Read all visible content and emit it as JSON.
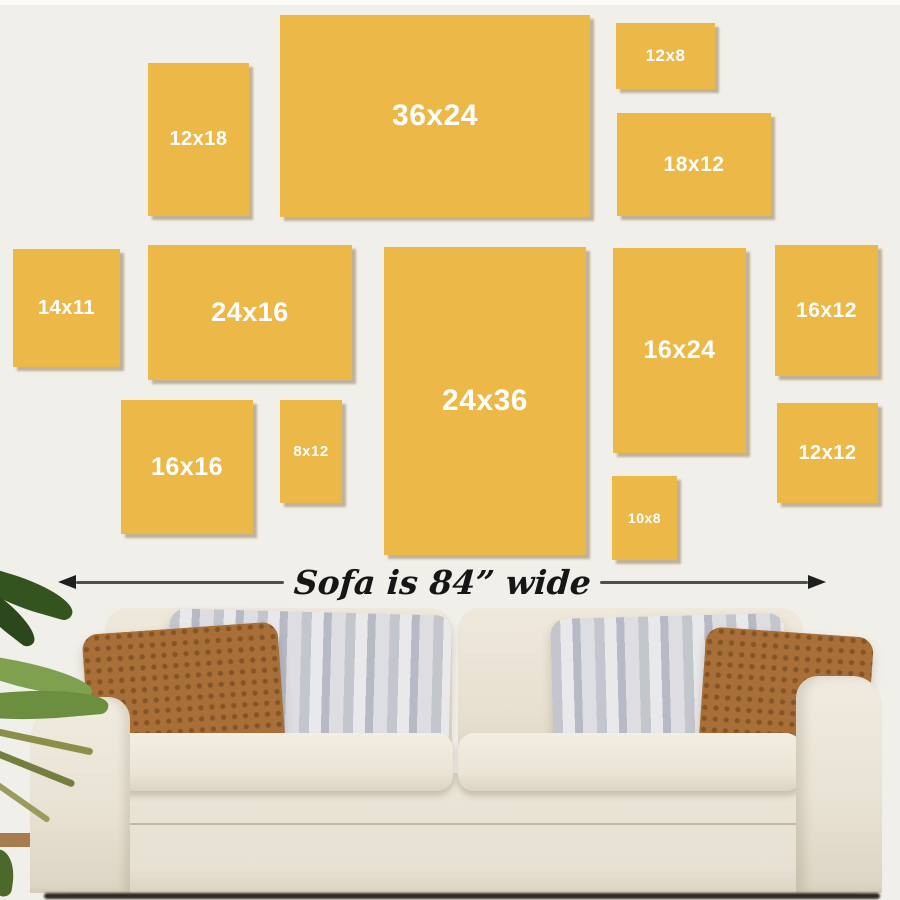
{
  "diagram": {
    "wall_color": "#F1EFE9",
    "frame_color": "#ECB848",
    "frame_label_color": "#FFFFFF",
    "frames": [
      {
        "label": "12x18",
        "x": 148,
        "y": 63,
        "w": 101,
        "h": 153,
        "font_px": 20
      },
      {
        "label": "36x24",
        "x": 280,
        "y": 15,
        "w": 310,
        "h": 202,
        "font_px": 30
      },
      {
        "label": "12x8",
        "x": 616,
        "y": 23,
        "w": 99,
        "h": 66,
        "font_px": 17
      },
      {
        "label": "18x12",
        "x": 617,
        "y": 113,
        "w": 154,
        "h": 103,
        "font_px": 21
      },
      {
        "label": "14x11",
        "x": 13,
        "y": 249,
        "w": 107,
        "h": 118,
        "font_px": 20
      },
      {
        "label": "24x16",
        "x": 148,
        "y": 245,
        "w": 204,
        "h": 135,
        "font_px": 27
      },
      {
        "label": "24x36",
        "x": 384,
        "y": 247,
        "w": 202,
        "h": 308,
        "font_px": 30
      },
      {
        "label": "16x24",
        "x": 613,
        "y": 248,
        "w": 133,
        "h": 205,
        "font_px": 25
      },
      {
        "label": "16x12",
        "x": 775,
        "y": 245,
        "w": 103,
        "h": 131,
        "font_px": 21
      },
      {
        "label": "16x16",
        "x": 121,
        "y": 400,
        "w": 132,
        "h": 134,
        "font_px": 25
      },
      {
        "label": "8x12",
        "x": 280,
        "y": 400,
        "w": 62,
        "h": 103,
        "font_px": 15
      },
      {
        "label": "10x8",
        "x": 612,
        "y": 476,
        "w": 65,
        "h": 84,
        "font_px": 14
      },
      {
        "label": "12x12",
        "x": 777,
        "y": 403,
        "w": 101,
        "h": 100,
        "font_px": 20
      }
    ],
    "annotation": {
      "text": "Sofa is 84” wide",
      "text_color": "#161616",
      "arrow_color": "#4F4F4F"
    }
  },
  "scene": {
    "sofa_fabric_color": "#E9E3D6",
    "pillow_brown_color": "#A86F38",
    "pillow_gray_color": "#C9CBD2",
    "plant_color": "#5E7A35"
  }
}
